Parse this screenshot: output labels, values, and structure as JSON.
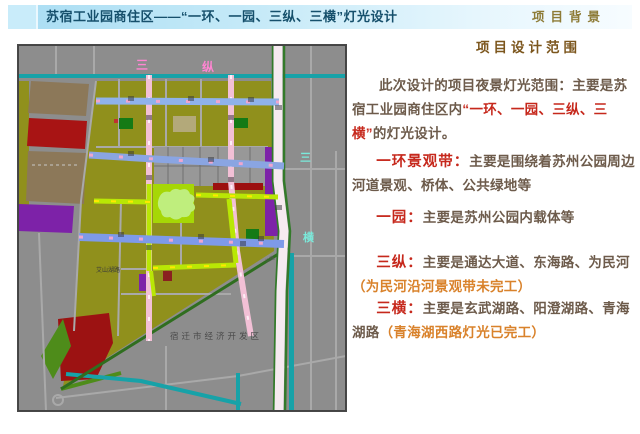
{
  "header": {
    "title": "苏宿工业园商住区——“一环、一园、三纵、三横”灯光设计",
    "corner_label": "项目背景"
  },
  "panel": {
    "heading": "项目设计范围",
    "intro_pre": "此次设计的项目夜景灯光范围：主要是苏宿工业园商住区内",
    "intro_highlight": "“一环、一园、三纵、三横”",
    "intro_post": "的灯光设计。",
    "items": [
      {
        "term": "一环景观带：",
        "desc": "主要是围绕着苏州公园周边河道景观、桥体、公共绿地等",
        "note": ""
      },
      {
        "term": "一园：",
        "desc": "主要是苏州公园内载体等",
        "note": ""
      },
      {
        "term": "三纵：",
        "desc": "主要是通达大道、东海路、为民河",
        "note": "（为民河沿河景观带未完工）"
      },
      {
        "term": "三横：",
        "desc": "主要是玄武湖路、阳澄湖路、青海湖路",
        "note": "（青海湖西路灯光已完工）"
      }
    ]
  },
  "map": {
    "label_zong_a": "三",
    "label_zong_b": "纵",
    "label_heng_a": "三",
    "label_heng_b": "横",
    "district_label": "宿迁市经济开发区",
    "small_road_label": "艾山湖路",
    "tiny_road_label": "公路"
  },
  "colors": {
    "accent_red": "#c6281c",
    "note_orange": "#d9822b",
    "body_brown": "#6d5b4b",
    "heading_brown": "#7c561d",
    "title_teal": "#16506c",
    "corner_olive": "#8d7b36",
    "map_olive": "#90901c",
    "map_park_green": "#a6d706",
    "road_blue": "#8fb2ea",
    "road_pink": "#f2c0d6",
    "ring_chartreuse": "#b9e705",
    "canal_teal": "#17a2a8"
  }
}
